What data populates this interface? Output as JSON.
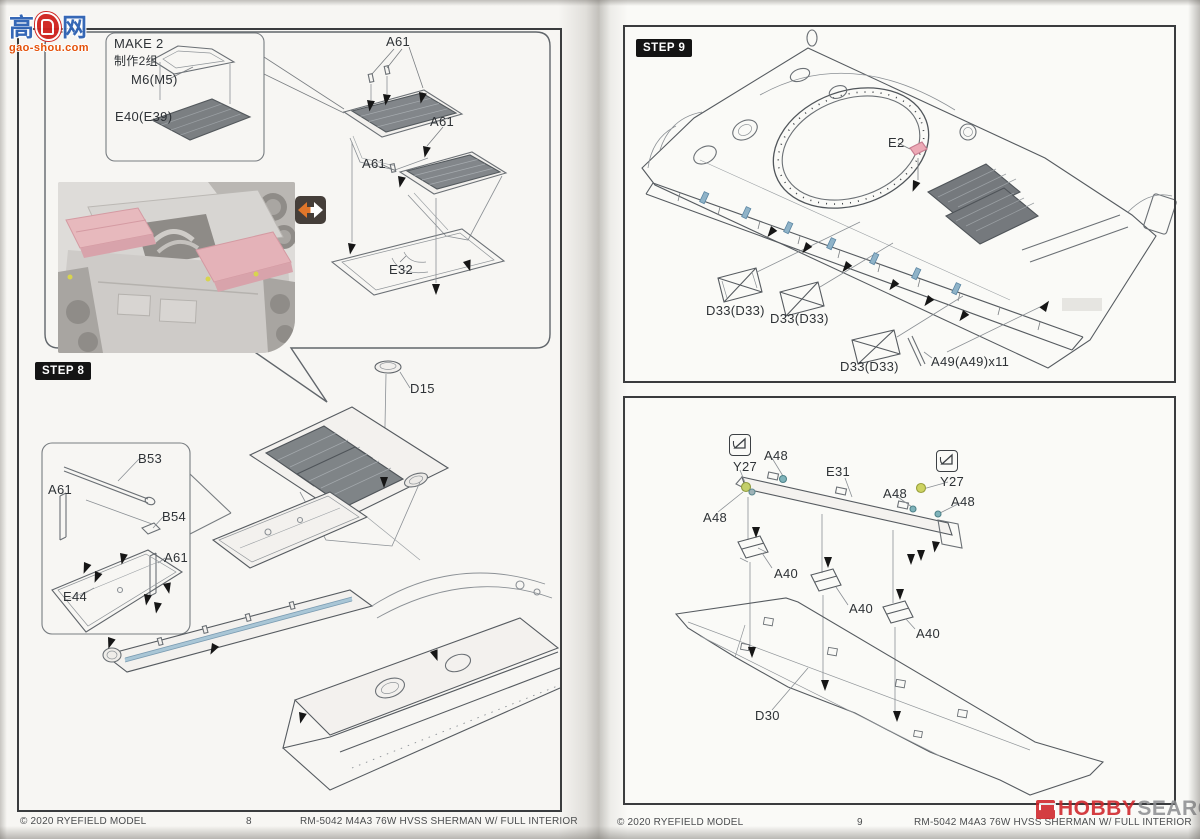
{
  "watermarks": {
    "gaoshou": {
      "char_left": "高",
      "char_right": "网",
      "url": "gao-shou.com"
    },
    "hobbysearch": {
      "word1": "HOBBY",
      "word2": "SEARCH"
    }
  },
  "left_page": {
    "step_label": "STEP 8",
    "make_box": {
      "title": "MAKE 2",
      "title_cn": "制作2组",
      "part_m6": "M6(M5)",
      "part_e40": "E40(E39)"
    },
    "labels": {
      "a61_top": "A61",
      "a61_mid": "A61",
      "a61_low": "A61",
      "e32": "E32",
      "d15": "D15",
      "b53": "B53",
      "a61_call_1": "A61",
      "b54": "B54",
      "a61_call_2": "A61",
      "e44": "E44"
    },
    "footer": {
      "copyright": "© 2020 RYEFIELD MODEL",
      "page": "8",
      "product": "RM-5042  M4A3 76W HVSS SHERMAN W/ FULL INTERIOR"
    }
  },
  "right_page": {
    "step_label": "STEP 9",
    "labels_step9": {
      "e2": "E2",
      "d33_1": "D33(D33)",
      "d33_2": "D33(D33)",
      "d33_3": "D33(D33)",
      "a49": "A49(A49)x11"
    },
    "labels_bottom": {
      "y27_1": "Y27",
      "y27_2": "Y27",
      "a48_1": "A48",
      "a48_2": "A48",
      "a48_3": "A48",
      "a48_4": "A48",
      "e31": "E31",
      "a40_1": "A40",
      "a40_2": "A40",
      "a40_3": "A40",
      "d30": "D30"
    },
    "footer": {
      "copyright": "© 2020 RYEFIELD MODEL",
      "page": "9",
      "product": "RM-5042  M4A3 76W HVSS SHERMAN W/ FULL INTERIOR"
    }
  },
  "colors": {
    "part_pink": "#e8aab4",
    "part_blue": "#8fb3c8",
    "part_teal": "#7fb3ba",
    "part_yellow": "#c3cf6a",
    "arrow_orange": "#e0762a"
  }
}
